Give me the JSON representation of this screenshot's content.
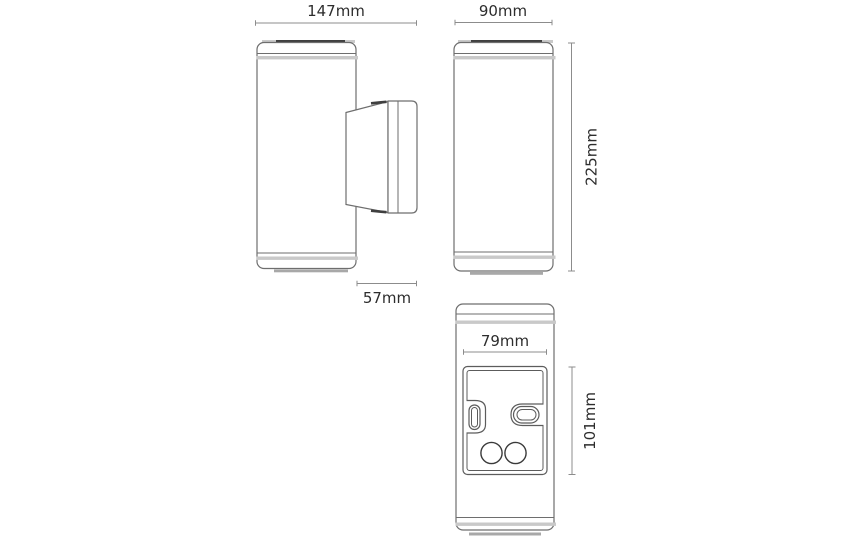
{
  "dimensions": {
    "side_total_width": "147mm",
    "front_width": "90mm",
    "front_height": "225mm",
    "bracket_depth": "57mm",
    "plate_width": "79mm",
    "plate_height": "101mm"
  },
  "colors": {
    "background": "#ffffff",
    "outline_gray": "#6e6e6e",
    "cap_dark_gray": "#3f3f3f",
    "seam_band_gray": "#c9c9c9",
    "shadow_gray": "#a8a8a8",
    "dimension_line_gray": "#8c8c8c",
    "label_text": "#2d2d2d"
  }
}
